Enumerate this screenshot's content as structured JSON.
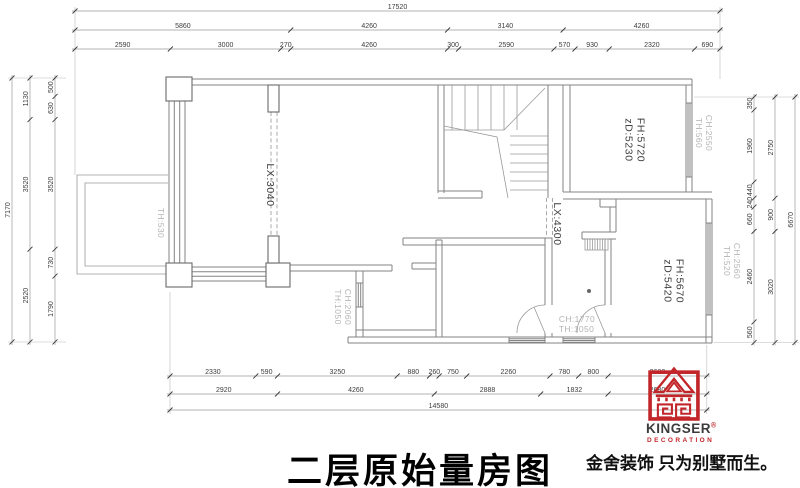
{
  "title": "二层原始量房图",
  "brand": {
    "name": "KINGSER",
    "reg": "®",
    "sub": "DECORATION",
    "tagline": "金舍装饰 只为别墅而生。"
  },
  "dimensions": {
    "top": {
      "rows": [
        [
          17520
        ],
        [
          5860,
          4260,
          3140,
          4260
        ],
        [
          2590,
          3000,
          270,
          4260,
          300,
          2590,
          570,
          930,
          2320,
          690
        ]
      ]
    },
    "bottom": {
      "rows": [
        [
          2330,
          590,
          3250,
          880,
          260,
          750,
          2260,
          780,
          800,
          2680
        ],
        [
          2920,
          4260,
          2888,
          1832,
          2680
        ],
        [
          14580
        ]
      ]
    },
    "left": {
      "cols": [
        [
          7170
        ],
        [
          1130,
          3520,
          2520
        ],
        [
          500,
          630,
          3520,
          730,
          1790
        ]
      ]
    },
    "right": {
      "cols": [
        [
          350,
          1960,
          440,
          240,
          660,
          2460,
          560
        ],
        [
          2750,
          900,
          3020
        ],
        [
          6670
        ]
      ]
    }
  },
  "room_labels": [
    {
      "id": "th530",
      "lines": [
        "TH:530"
      ]
    },
    {
      "id": "lx3040",
      "lines": [
        "LX:3040"
      ]
    },
    {
      "id": "ch2060",
      "lines": [
        "CH:2060",
        "TH:1050"
      ]
    },
    {
      "id": "lx4300",
      "lines": [
        "LX:4300"
      ]
    },
    {
      "id": "fh5720",
      "lines": [
        "FH:5720",
        "zD:5230"
      ]
    },
    {
      "id": "ch2550",
      "lines": [
        "CH:2550",
        "TH:560"
      ]
    },
    {
      "id": "fh5670",
      "lines": [
        "FH:5670",
        "zD:5420"
      ]
    },
    {
      "id": "ch2560",
      "lines": [
        "CH:2560",
        "TH:520"
      ]
    },
    {
      "id": "ch1770",
      "lines": [
        "CH:1770",
        "TH:1050"
      ]
    }
  ],
  "colors": {
    "brand_red": "#c3262a",
    "wall_gray": "#838383",
    "label_muted": "#b4b4b4"
  }
}
